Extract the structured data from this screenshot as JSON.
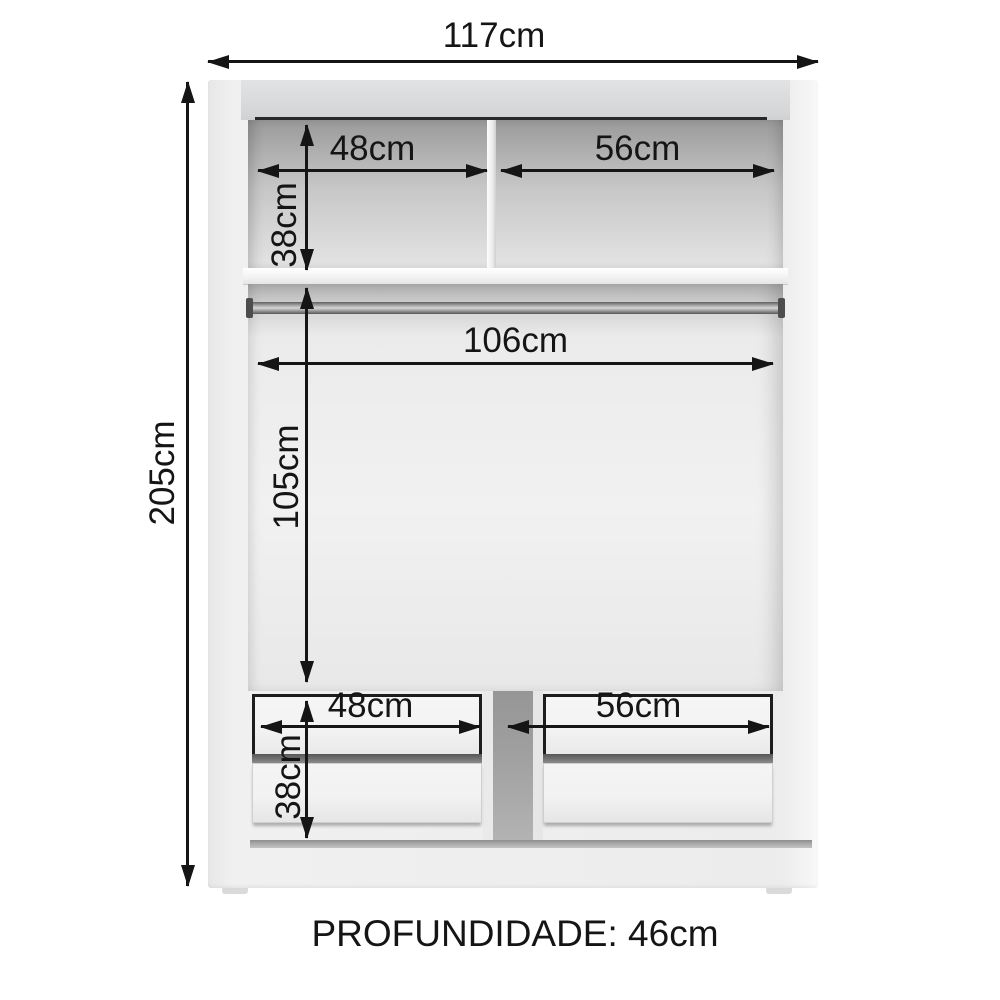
{
  "annotations": {
    "overall_width": "117cm",
    "overall_height": "205cm",
    "upper_shelf": {
      "left_width": "48cm",
      "right_width": "56cm",
      "height": "38cm"
    },
    "hanging_area": {
      "rod_width": "106cm",
      "height": "105cm"
    },
    "drawers": {
      "left_width": "48cm",
      "right_width": "56cm",
      "height": "38cm"
    },
    "depth_note": "PROFUNDIDADE: 46cm"
  },
  "colors": {
    "bg": "#ffffff",
    "ink": "#151515",
    "carcass": "#ededed",
    "top_edge": "#d6d7d9",
    "interior_dark": "#9a9a9a",
    "interior_light": "#f1f1f1",
    "gap_gray": "#9f9f9f",
    "drawer_face": "#f2f2f2",
    "drawer_shadow": "#565656",
    "rod_dark": "#5f5f5f",
    "rod_light": "#d6d6d6",
    "kick": "#a9a9a9"
  }
}
